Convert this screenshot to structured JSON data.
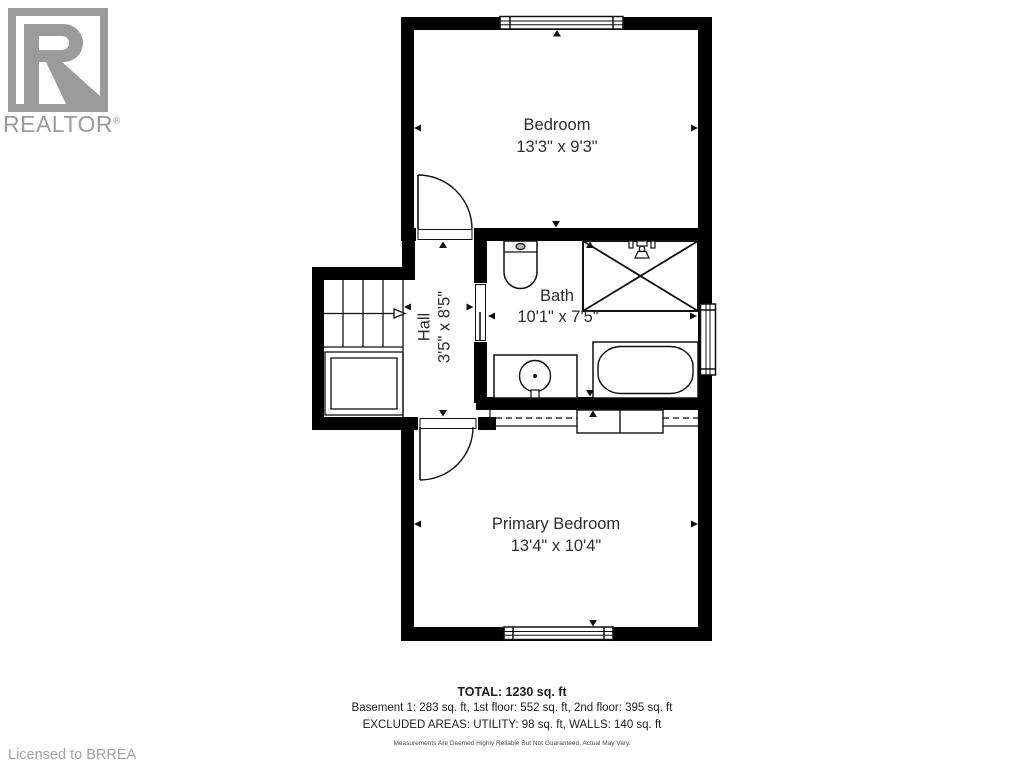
{
  "branding": {
    "logo_word": "REALTOR",
    "registered_mark": "®",
    "licensed_text": "Licensed to BRREA",
    "logo_color": "#9b9b9b"
  },
  "rooms": [
    {
      "name": "Bedroom",
      "dimensions": "13'3\" x 9'3\""
    },
    {
      "name": "Bath",
      "dimensions": "10'1\" x 7'5\""
    },
    {
      "name": "Hall",
      "dimensions": "3'5\" x 8'5\""
    },
    {
      "name": "Primary Bedroom",
      "dimensions": "13'4\" x 10'4\""
    }
  ],
  "fixtures": [
    "toilet",
    "shower",
    "bathtub",
    "vanity-sink",
    "stairs-up",
    "closet",
    "windows",
    "doors"
  ],
  "summary": {
    "total": "TOTAL: 1230 sq. ft",
    "floors": "Basement 1: 283 sq. ft, 1st floor: 552 sq. ft, 2nd floor: 395 sq. ft",
    "excluded": "EXCLUDED AREAS: UTILITY: 98 sq. ft, WALLS: 140 sq. ft",
    "disclaimer": "Measurements Are Deemed Highly Reliable But Not Guaranteed. Actual May Vary."
  },
  "colors": {
    "wall": "#000000",
    "line": "#111111",
    "text": "#2d2d2d",
    "gray": "#9b9b9b"
  }
}
